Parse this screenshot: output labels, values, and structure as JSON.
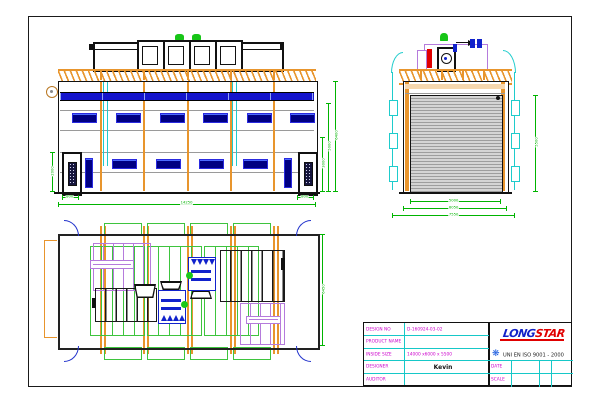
{
  "title_block": {
    "rows": [
      {
        "label": "DESIGN NO",
        "value": "D-160924-03-02"
      },
      {
        "label": "PRODUCT NAME",
        "value": ""
      },
      {
        "label": "INSIDE SIZE",
        "value": "14000 x6000 x 5500"
      },
      {
        "label": "DESIGNER",
        "value": "Kevin"
      },
      {
        "label": "AUDITOR",
        "value": ""
      }
    ],
    "date_label": "DATE",
    "scale_label": "SCALE",
    "iso_text": "UNI EN ISO 9001 - 2000",
    "logo": {
      "part1": "LONG",
      "part2": "STAR"
    }
  },
  "dimensions": {
    "front_width": "14250",
    "front_door_left": "800",
    "front_door_right": "800",
    "front_door_height": "2000",
    "front_h_inner": "3000",
    "front_h_mid": "5000",
    "front_h_outer": "6400",
    "side_door_width": "5000",
    "side_outer_width": "6050",
    "side_total_width": "7550",
    "side_door_height": "5500",
    "plan_depth": "6450"
  },
  "colors": {
    "dimension_green": "#00b400",
    "structure_orange": "#e8952d",
    "window_blue": "#000082",
    "band_blue": "#1414cc",
    "duct_cyan": "#1ecccc",
    "equipment_violet": "#b57bdc",
    "fan_blue": "#1122cc",
    "label_magenta": "#cc00cc",
    "logo_blue": "#1222c8",
    "logo_red": "#e00000"
  }
}
